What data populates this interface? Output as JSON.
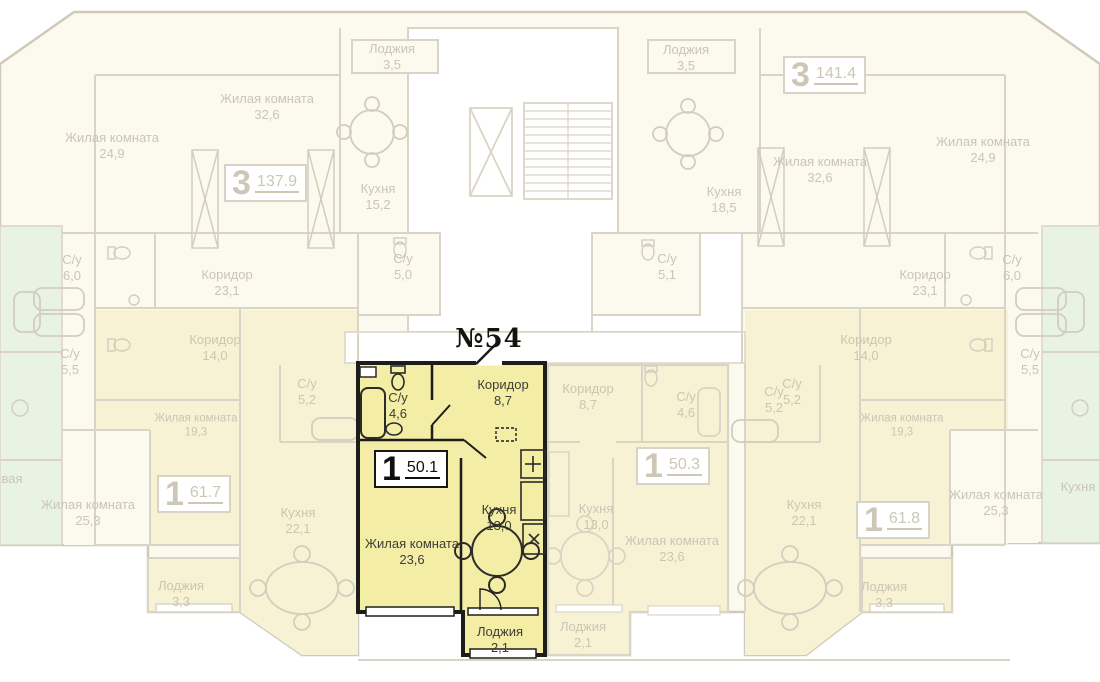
{
  "apartment": {
    "number": "№54",
    "badge": {
      "rooms": "1",
      "area": "50.1"
    },
    "rooms": [
      {
        "name": "С/у",
        "area": "4,6"
      },
      {
        "name": "Коридор",
        "area": "8,7"
      },
      {
        "name": "Кухня",
        "area": "13,0"
      },
      {
        "name": "Жилая комната",
        "area": "23,6"
      },
      {
        "name": "Лоджия",
        "area": "2,1"
      }
    ]
  },
  "background": {
    "badges": [
      {
        "rooms": "3",
        "area": "137.9"
      },
      {
        "rooms": "3",
        "area": "141.4"
      },
      {
        "rooms": "1",
        "area": "61.7"
      },
      {
        "rooms": "1",
        "area": "50.3"
      },
      {
        "rooms": "1",
        "area": "61.8"
      }
    ],
    "labels": [
      {
        "name": "Жилая комната",
        "area": "24,9"
      },
      {
        "name": "Жилая комната",
        "area": "32,6"
      },
      {
        "name": "Лоджия",
        "area": "3,5"
      },
      {
        "name": "Кухня",
        "area": "15,2"
      },
      {
        "name": "Лоджия",
        "area": "3,5"
      },
      {
        "name": "Кухня",
        "area": "18,5"
      },
      {
        "name": "Жилая комната",
        "area": "32,6"
      },
      {
        "name": "Жилая комната",
        "area": "24,9"
      },
      {
        "name": "С/у",
        "area": "6,0"
      },
      {
        "name": "Коридор",
        "area": "23,1"
      },
      {
        "name": "С/у",
        "area": "5,0"
      },
      {
        "name": "С/у",
        "area": "5,1"
      },
      {
        "name": "Коридор",
        "area": "23,1"
      },
      {
        "name": "С/у",
        "area": "6,0"
      },
      {
        "name": "С/у",
        "area": "5,5"
      },
      {
        "name": "Коридор",
        "area": "14,0"
      },
      {
        "name": "С/у",
        "area": "5,2"
      },
      {
        "name": "Жилая комната",
        "area": "19,3"
      },
      {
        "name": "Коридор",
        "area": "14,0"
      },
      {
        "name": "С/у",
        "area": "5,2"
      },
      {
        "name": "Жилая комната",
        "area": "19,3"
      },
      {
        "name": "С/у",
        "area": "5,5"
      },
      {
        "name": "Коридор",
        "area": "8,7"
      },
      {
        "name": "С/у",
        "area": "4,6"
      },
      {
        "name": "С/у",
        "area": "5,2"
      },
      {
        "name": "Кухня",
        "area": "13,0"
      },
      {
        "name": "Жилая комната",
        "area": "23,6"
      },
      {
        "name": "Кухня",
        "area": "22,1"
      },
      {
        "name": "Лоджия",
        "area": "2,1"
      },
      {
        "name": "Жилая комната",
        "area": "25,3"
      },
      {
        "name": "Кухня",
        "area": "22,1"
      },
      {
        "name": "Лоджия",
        "area": "3,3"
      },
      {
        "name": "Жилая комната",
        "area": "25,3"
      },
      {
        "name": "Лоджия",
        "area": "3,3"
      },
      {
        "name": "Кухня",
        "area": ""
      },
      {
        "name": "вая",
        "area": ""
      }
    ]
  },
  "icons": [
    "bathtub-icon",
    "toilet-icon",
    "sink-icon",
    "dining-table-icon",
    "wardrobe-icon",
    "stairs-icon",
    "elevator-icon",
    "door-arc-icon"
  ],
  "colors": {
    "highlight_fill": "#f3eda6",
    "highlight_wall": "#1d1d1b",
    "cream_fill": "#fcf9ee",
    "light_yellow_fill": "#f7f2d4",
    "green_fill": "#e8f3e3",
    "faded_wall": "#d9d4c6",
    "faded_text": "#cbc5b4",
    "dark_text": "#3f3e36"
  }
}
